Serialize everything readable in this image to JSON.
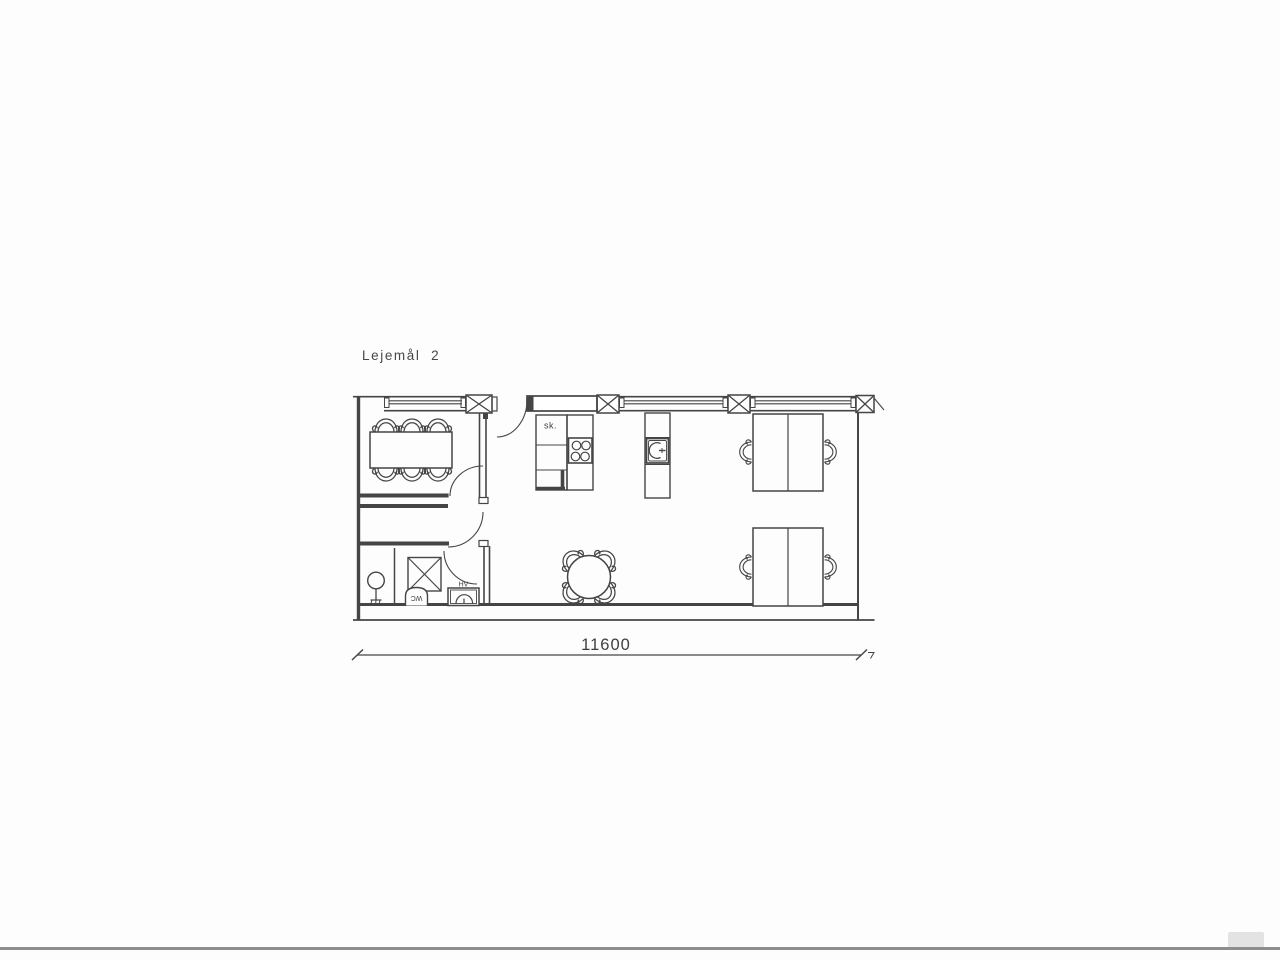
{
  "page": {
    "title": "Lejemål  2"
  },
  "plan": {
    "labels": {
      "kitchen_cabinet": "sk.",
      "toilet": "WC",
      "hand_basin": "HV"
    },
    "dimension": {
      "total_width": "11600"
    }
  },
  "colors": {
    "ink": "#454545",
    "text": "#3f3f3f",
    "paper": "#fdfdfd",
    "scan_bar": "#8e8e8e"
  }
}
